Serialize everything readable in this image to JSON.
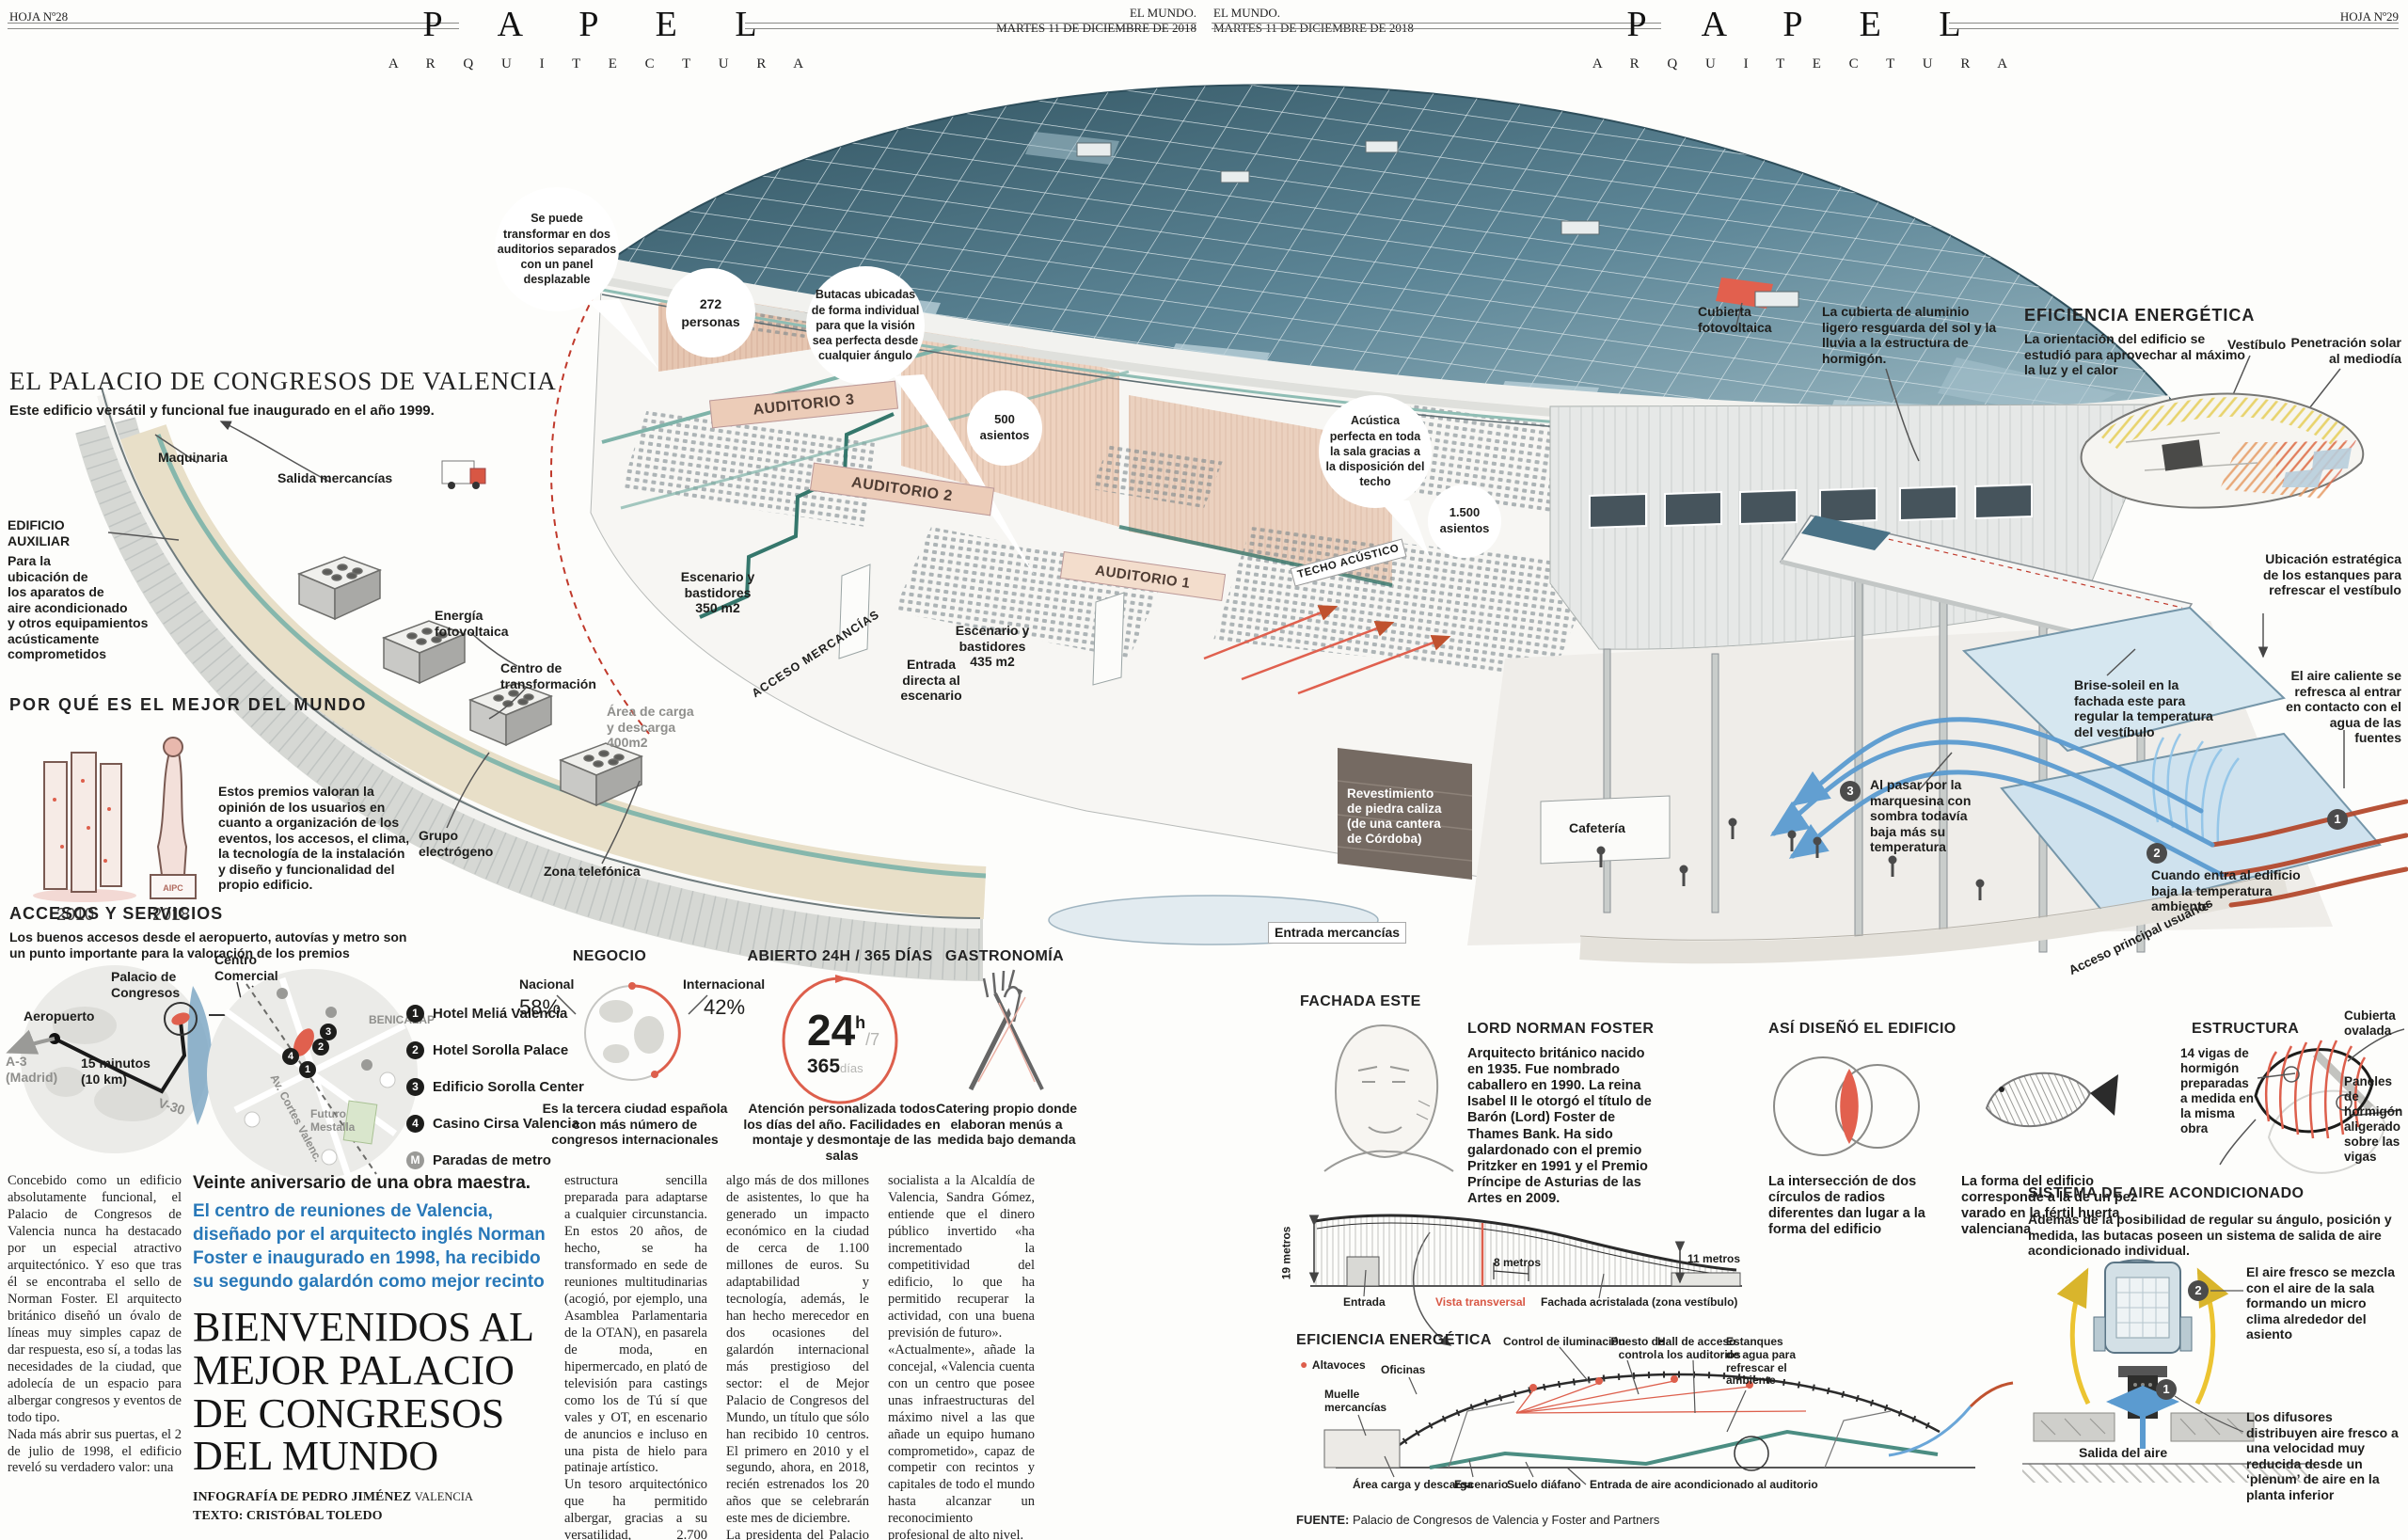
{
  "header_left": {
    "hoja": "HOJA Nº28",
    "masthead": "P A P E L",
    "section": "A R Q U I T E C T U R A",
    "paper": "EL MUNDO.",
    "date": "MARTES 11 DE DICIEMBRE DE 2018"
  },
  "header_right": {
    "hoja": "HOJA Nº29",
    "masthead": "P A P E L",
    "section": "A R Q U I T E C T U R A",
    "paper": "EL MUNDO.",
    "date": "MARTES 11 DE DICIEMBRE DE 2018"
  },
  "intro": {
    "title": "EL PALACIO DE CONGRESOS DE VALENCIA",
    "subtitle": "Este edificio versátil y funcional fue inaugurado en el año 1999."
  },
  "building": {
    "maquinaria": "Maquinaria",
    "salida_mercancias": "Salida mercancías",
    "edificio_auxiliar_title": "EDIFICIO\nAUXILIAR",
    "edificio_auxiliar_text": "Para la\nubicación de\nlos aparatos de\naire acondicionado\ny otros equipamientos\nacústicamente\ncomprometidos",
    "energia": "Energía\nfotovoltaica",
    "centro_transformacion": "Centro de\ntransformación",
    "grupo": "Grupo\nelectrógeno",
    "zona": "Zona telefónica",
    "area_carga": "Área de carga\ny descarga\n400m2",
    "acceso_mercancias": "ACCESO MERCANCÍAS",
    "bubble_panel": "Se puede\ntransformar en dos\nauditorios separados\ncon un panel\ndesplazable",
    "bubble_butacas": "Butacas ubicadas\nde forma individual\npara que la visión\nsea perfecta desde\ncualquier ángulo",
    "bubble_acustica": "Acústica\nperfecta en toda\nla sala gracias a\nla disposición del\ntecho",
    "c272": "272\npersonas",
    "c500": "500\nasientos",
    "c1500": "1.500\nasientos",
    "auditorio1": "AUDITORIO 1",
    "auditorio2": "AUDITORIO 2",
    "auditorio3": "AUDITORIO 3",
    "techo": "TECHO ACÚSTICO",
    "esc350": "Escenario y\nbastidores\n350 m2",
    "esc435": "Escenario y\nbastidores\n435 m2",
    "entrada_escenario": "Entrada\ndirecta al\nescenario",
    "cubierta_foto": "Cubierta\nfotovoltaica",
    "cubierta_alu": "La cubierta de aluminio\nligero resguarda del sol y la\nlluvia a la estructura de\nhormigón.",
    "revestimiento": "Revestimiento\nde piedra caliza\n(de una cantera\nde Córdoba)",
    "cafeteria": "Cafetería",
    "entrada_mercancias": "Entrada mercancías",
    "acceso_principal": "Acceso principal usuarios"
  },
  "por_que": {
    "title": "POR QUÉ ES EL MEJOR DEL MUNDO",
    "y2010": "2010",
    "y2018": "2018",
    "text": "Estos premios valoran la opinión de los usuarios en cuanto a organización de los eventos, los accesos, el clima, la tecnología de la instalación y diseño y funcionalidad del propio edificio."
  },
  "accesos": {
    "title": "ACCESOS Y SERVICIOS",
    "subtitle": "Los buenos accesos desde el aeropuerto, autovías y metro son un punto importante para la valoración de los premios",
    "aeropuerto": "Aeropuerto",
    "a3": "A-3\n(Madrid)",
    "minutos": "15 minutos\n(10 km)",
    "palacio": "Palacio de\nCongresos",
    "centro": "Centro\nComercial",
    "v30": "V-30",
    "benicalap": "BENICALAP",
    "futuro": "Futuro\nMestalla",
    "avenida": "Av. Cortes Valenc.",
    "hotel1": "Hotel Meliá Valencia",
    "hotel2": "Hotel Sorolla Palace",
    "hotel3": "Edificio Sorolla Center",
    "hotel4": "Casino Cirsa Valencia",
    "metro": "Paradas de metro",
    "n1": "1",
    "n2": "2",
    "n3": "3",
    "n4": "4",
    "m": "M"
  },
  "negocio": {
    "title": "NEGOCIO",
    "nacional": "Nacional",
    "nacional_pct": "58%",
    "internacional": "Internacional",
    "internacional_pct": "42%",
    "text": "Es la tercera ciudad española con más número de congresos internacionales"
  },
  "abierto": {
    "title": "ABIERTO 24H / 365 DÍAS",
    "big": "24",
    "sup": "h",
    "per": "/7",
    "dias": "365",
    "dias_sub": "días",
    "text": "Atención personalizada todos los días del año. Facilidades en montaje y desmontaje de las salas"
  },
  "gastronomia": {
    "title": "GASTRONOMÍA",
    "text": "Catering propio donde elaboran menús a medida bajo demanda"
  },
  "eficiencia_top": {
    "title": "EFICIENCIA ENERGÉTICA",
    "text": "La orientación del edificio se estudió para aprovechar al máximo la luz y el calor",
    "vestibulo": "Vestíbulo",
    "penetracion": "Penetración solar\nal mediodía"
  },
  "flujo": {
    "ubicacion": "Ubicación estratégica de los estanques para refrescar el vestíbulo",
    "aire_caliente": "El aire caliente se refresca al entrar en contacto con el agua de las fuentes",
    "brise": "Brise-soleil en la\nfachada este para\nregular la temperatura\ndel vestíbulo",
    "marquesina": "Al pasar por la\nmarquesina con\nsombra todavía\nbaja más su\ntemperatura",
    "entra": "Cuando entra al edificio\nbaja la temperatura\nambiente",
    "n1": "1",
    "n2": "2",
    "n3": "3"
  },
  "foster": {
    "title": "LORD NORMAN FOSTER",
    "bio": "Arquitecto británico nacido en 1935. Fue nombrado caballero en 1990. La reina Isabel II le otorgó el título de Barón (Lord) Foster de Thames Bank. Ha sido galardonado con el premio Pritzker en 1991 y el Premio Príncipe de Asturias de las Artes en 2009."
  },
  "diseno": {
    "title": "ASÍ DISEÑÓ EL EDIFICIO",
    "circulos": "La intersección de dos círculos de radios diferentes dan lugar a la forma del edificio",
    "pez": "La forma del edificio corresponde a la de un pez varado en la fértil huerta valenciana"
  },
  "estructura": {
    "title": "ESTRUCTURA",
    "vigas": "14 vigas de\nhormigón\npreparadas\na medida en\nla misma\nobra",
    "cubierta": "Cubierta\novalada",
    "paneles": "Paneles de\nhormigón\naligerado\nsobre las\nvigas"
  },
  "fachada": {
    "title": "FACHADA ESTE",
    "m19": "19 metros",
    "entrada": "Entrada",
    "vista": "Vista transversal",
    "m8": "8 metros",
    "acristalada": "Fachada acristalada (zona vestíbulo)",
    "m11": "11 metros"
  },
  "seccion": {
    "title": "EFICIENCIA ENERGÉTICA",
    "altavoces": "Altavoces",
    "oficinas": "Oficinas",
    "muelle": "Muelle\nmercancías",
    "control": "Control de iluminación",
    "puesto": "Puesto de\ncontrol",
    "hall": "Hall de acceso\na los auditorios",
    "estanques": "Estanques\nde agua para\nrefrescar el\nambiente",
    "area": "Área carga y descarga",
    "escenario": "Escenario",
    "suelo": "Suelo diáfano",
    "entrada_aire": "Entrada de aire acondicionado al auditorio"
  },
  "aire": {
    "title": "SISTEMA DE AIRE ACONDICIONADO",
    "intro": "Además de la posibilidad de regular su ángulo, posición y medida, las butacas poseen un sistema de salida de aire acondicionado individual.",
    "d2": "El aire fresco se mezcla con el aire de la sala formando un micro clima alrededor del asiento",
    "d1": "Los difusores distribuyen aire fresco a una velocidad muy reducida desde un ‘plenum’ de aire en la planta inferior",
    "salida": "Salida del aire",
    "n1": "1",
    "n2": "2"
  },
  "fuente": {
    "label": "FUENTE:",
    "text": "Palacio de Congresos de Valencia y Foster and Partners"
  },
  "article": {
    "kicker": "Veinte aniversario de una obra maestra.",
    "deck": "El centro de reuniones de Valencia,\ndiseñado por el arquitecto inglés Norman\nFoster e inaugurado en 1998, ha recibido\nsu segundo galardón como mejor recinto",
    "headline": "BIENVENIDOS AL\nMEJOR PALACIO\nDE CONGRESOS\nDEL MUNDO",
    "credit1": "INFOGRAFÍA DE PEDRO JIMÉNEZ",
    "credit1b": "VALENCIA",
    "credit2": "TEXTO: CRISTÓBAL TOLEDO",
    "col1": "Concebido como un edificio absolutamente funcional, el Palacio de Congresos de Valencia nunca ha destacado por un especial atractivo arquitectónico. Y eso que tras él se encontraba el sello de Norman Foster. El arquitecto británico diseñó un óvalo de líneas muy simples capaz de dar respuesta, eso sí, a todas las necesidades de la ciudad, que adolecía de un espacio para albergar congresos y eventos de todo tipo.\nNada más abrir sus puertas, el 2 de julio de 1998, el edificio reveló su verdadero valor: una",
    "col2": "estructura sencilla preparada para adaptarse a cualquier circunstancia. En estos 20 años, de hecho, se ha transformado en sede de reuniones multitudinarias (acogió, por ejemplo, una Asamblea Parlamentaria de la OTAN), en pasarela de moda, en hipermercado, en plató de televisión para castings como los de Tú sí que vales y OT, en escenario de anuncios e incluso en una pista de hielo para patinaje artístico.\nUn tesoro arquitectónico que ha permitido albergar, gracias a su versatilidad, 2.700 eventos, muchos de ellos internacionales, con",
    "col3": "algo más de dos millones de asistentes, lo que ha generado un impacto económico en la ciudad de cerca de 1.100 millones de euros. Su adaptabilidad y tecnología, además, le han hecho merecedor en dos ocasiones del galardón internacional más prestigioso del sector: el de Mejor Palacio de Congresos del Mundo, un título que sólo han recibido 10 centros. El primero en 2010 y el segundo, ahora, en 2018, recién estrenados los 20 años que se celebrarán este mes de diciembre.\nLa presidenta del Palacio de Congresos y candidata",
    "col4": "socialista a la Alcaldía de Valencia, Sandra Gómez, entiende que el dinero público invertido «ha incrementado la competitividad del edificio, lo que ha permitido recuperar la actividad, con una buena previsión de futuro».\n«Actualmente», añade la concejal, «Valencia cuenta con un centro que posee unas infraestructuras del máximo nivel a las que añade un equipo humano comprometido», capaz de competir con recintos y capitales de todo el mundo hasta alcanzar un reconocimiento profesional de alto nivel."
  }
}
